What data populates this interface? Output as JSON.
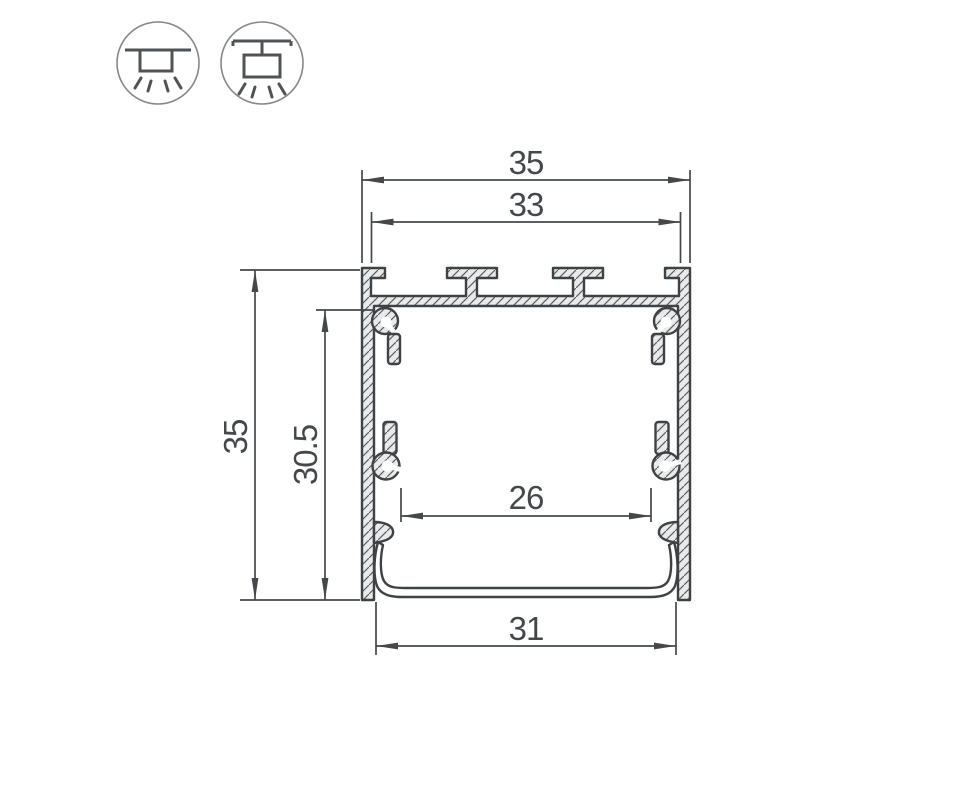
{
  "drawing": {
    "dimensions": {
      "outer_width": "35",
      "inner_top_width": "33",
      "outer_height": "35",
      "inner_height": "30.5",
      "inner_bottom_width": "26",
      "bottom_cover_width": "31"
    },
    "icons": [
      {
        "name": "surface-mount-icon"
      },
      {
        "name": "pendant-mount-icon"
      }
    ],
    "colors": {
      "line": "#3f4245",
      "dimension": "#45484b",
      "aluminum_fill": "#e9eaeb",
      "background": "#ffffff"
    }
  }
}
